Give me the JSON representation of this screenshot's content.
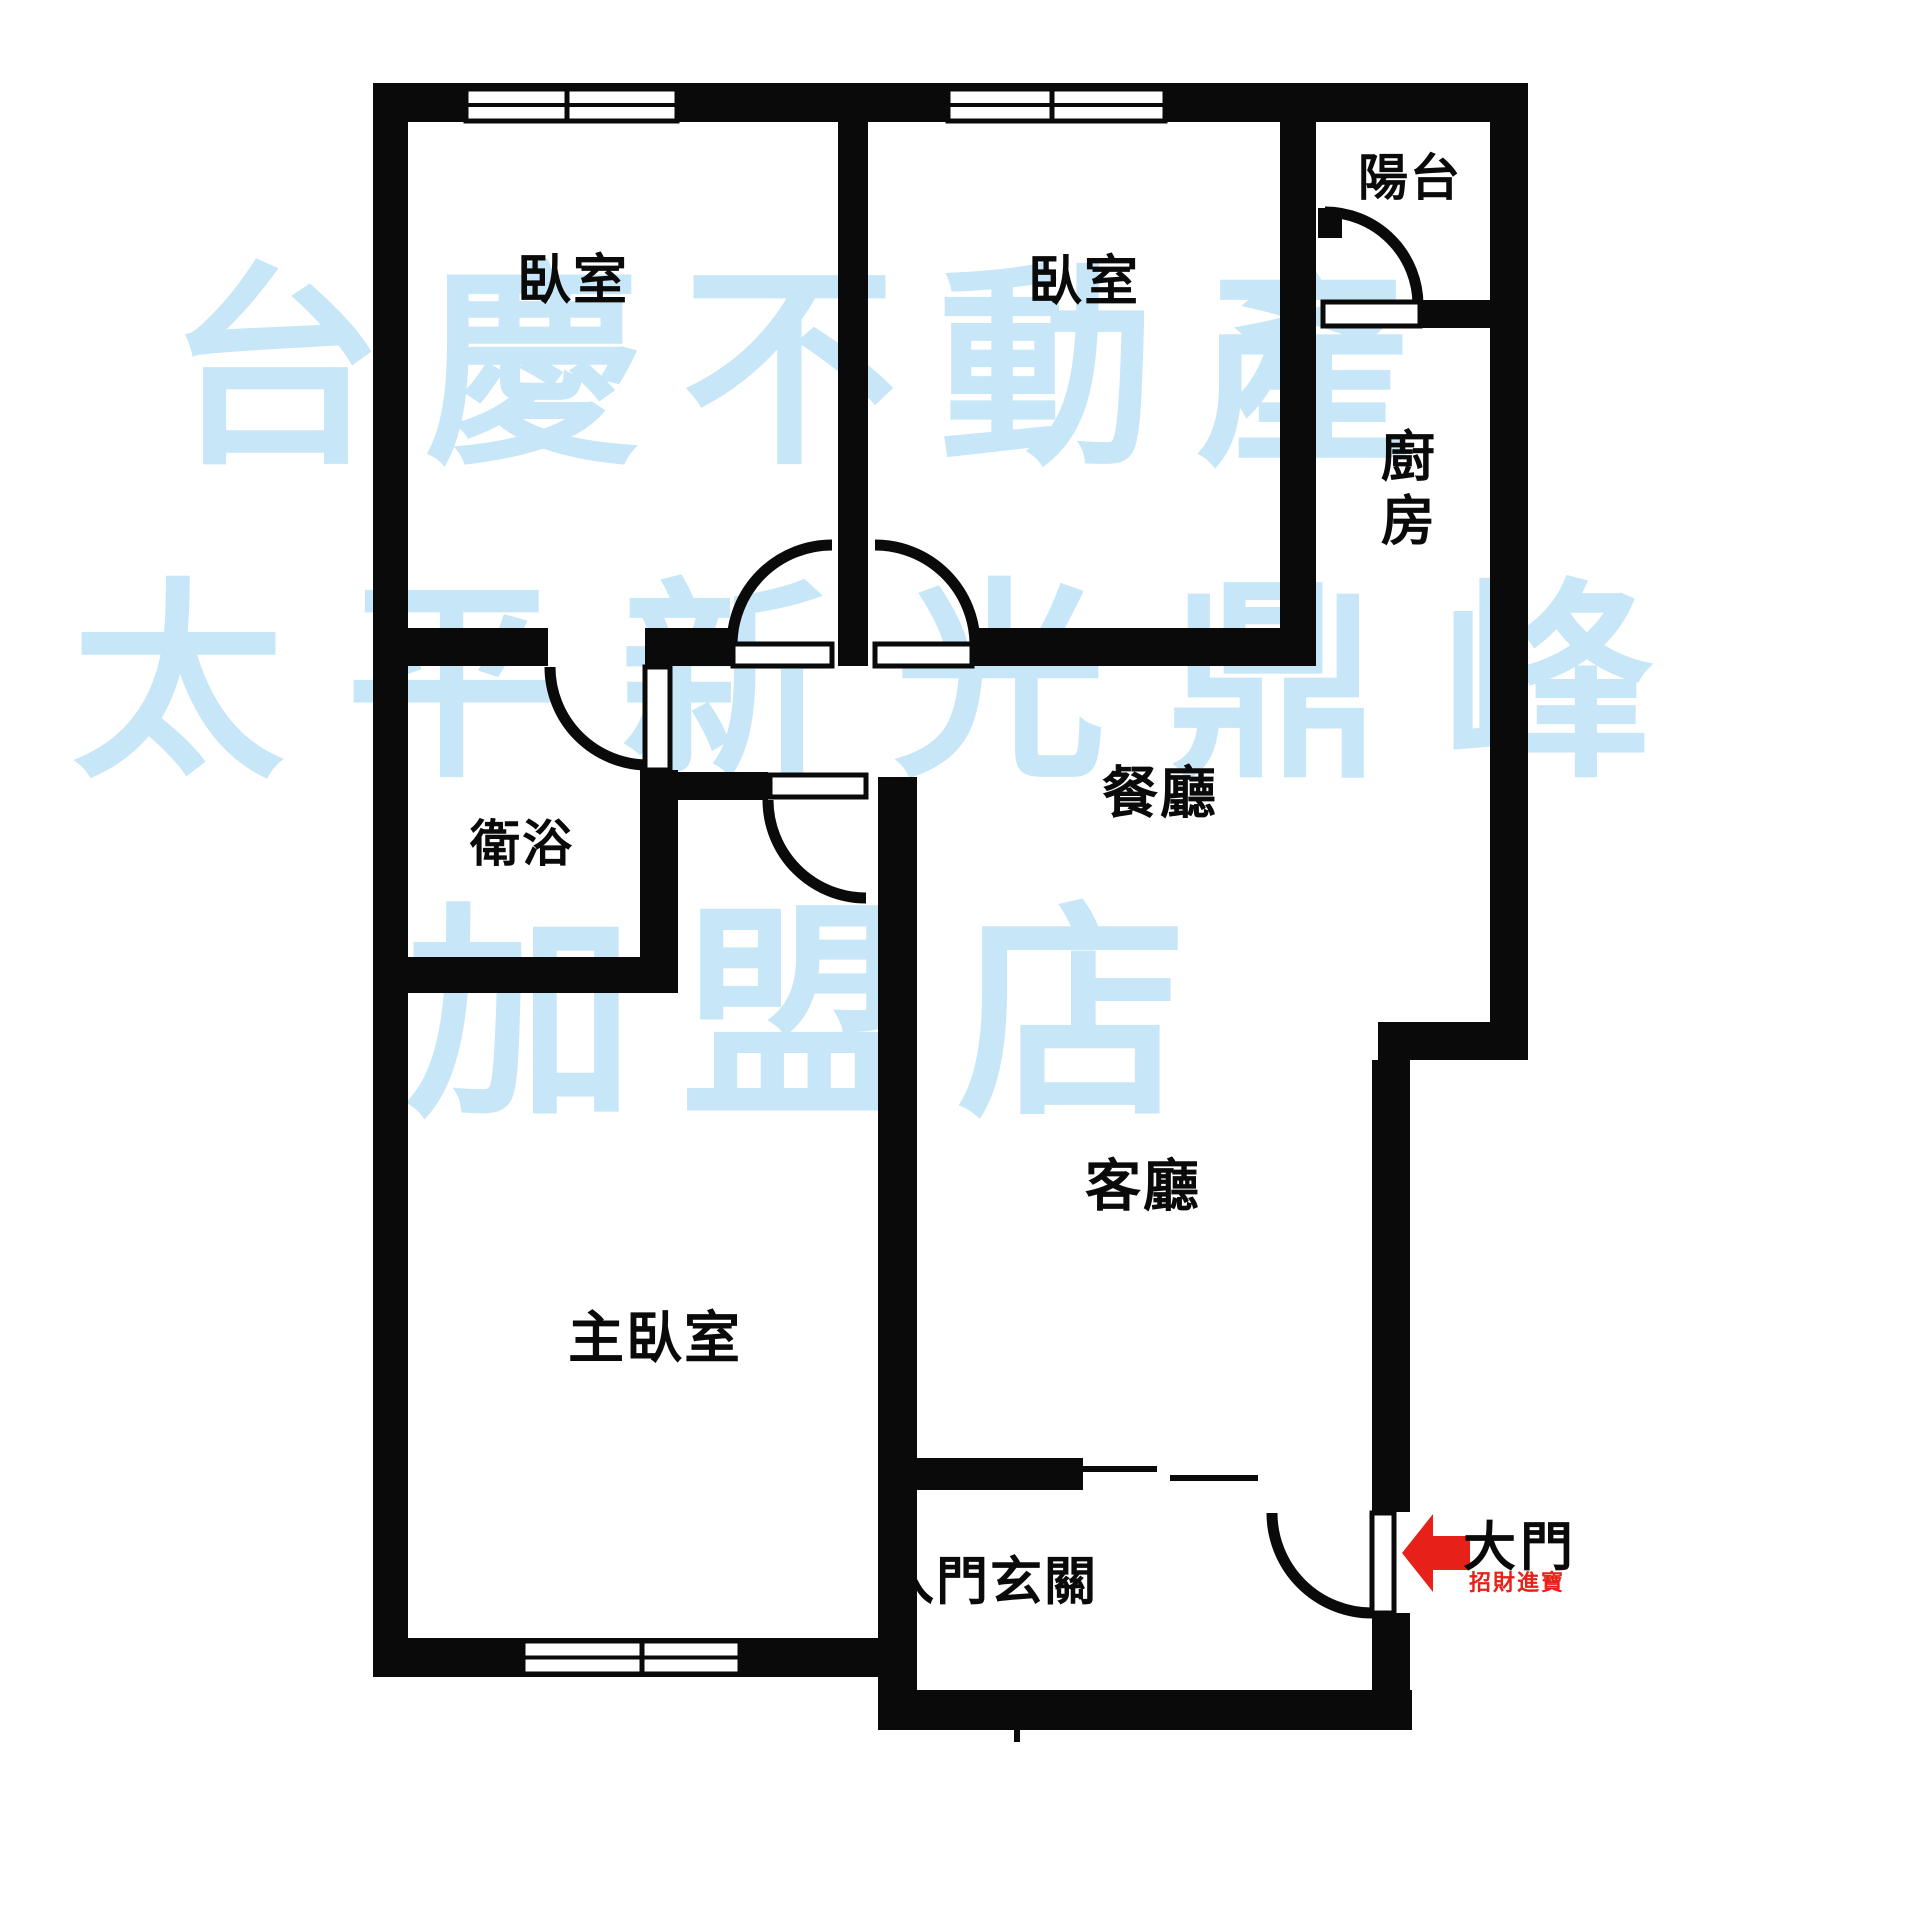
{
  "page": {
    "background": "#ffffff",
    "wall_color": "#0a0a0a",
    "label_color": "#0a0a0a",
    "accent_red": "#e7211a",
    "watermark_color": "#c7e6f7"
  },
  "watermark": {
    "rows": [
      {
        "text": "台慶不動產",
        "left": 168,
        "top": 262,
        "font_size": 215,
        "letter_spacing": 42
      },
      {
        "text": "太平新光鼎峰",
        "left": 72,
        "top": 578,
        "font_size": 212,
        "letter_spacing": 62
      },
      {
        "text": "加盟店",
        "left": 405,
        "top": 902,
        "font_size": 230,
        "letter_spacing": 46
      }
    ]
  },
  "rooms": [
    {
      "id": "bedroom-1",
      "label": "臥室",
      "cx": 573,
      "cy": 281,
      "font_size": 54
    },
    {
      "id": "bedroom-2",
      "label": "臥室",
      "cx": 1084,
      "cy": 282,
      "font_size": 54
    },
    {
      "id": "balcony",
      "label": "陽台",
      "cx": 1410,
      "cy": 178,
      "font_size": 50
    },
    {
      "id": "kitchen",
      "label": "廚房",
      "cx": 1402,
      "cy": 492,
      "font_size": 54,
      "vertical": true
    },
    {
      "id": "bathroom",
      "label": "衛浴",
      "cx": 522,
      "cy": 844,
      "font_size": 50
    },
    {
      "id": "dining-room",
      "label": "餐廳",
      "cx": 1160,
      "cy": 795,
      "font_size": 56
    },
    {
      "id": "living-room",
      "label": "客廳",
      "cx": 1143,
      "cy": 1188,
      "font_size": 56
    },
    {
      "id": "master-bedroom",
      "label": "主臥室",
      "cx": 655,
      "cy": 1340,
      "font_size": 56
    },
    {
      "id": "foyer",
      "label": "入門玄關",
      "cx": 990,
      "cy": 1583,
      "font_size": 52
    }
  ],
  "entrance": {
    "label": "大門",
    "label_cx": 1520,
    "label_cy": 1543,
    "label_font_size": 53,
    "blessing": "招財進寶",
    "blessing_cx": 1517,
    "blessing_cy": 1581,
    "blessing_font_size": 22,
    "arrow_points": "1402,1553 1433,1514 1433,1536 1470,1536 1470,1570 1433,1570 1433,1592"
  },
  "plan": {
    "canvas": {
      "width": 1920,
      "height": 1920
    },
    "walls": [
      {
        "name": "outer-top",
        "x": 373,
        "y": 83,
        "w": 1155,
        "h": 39
      },
      {
        "name": "outer-left",
        "x": 373,
        "y": 83,
        "w": 35,
        "h": 1594
      },
      {
        "name": "master-bottom",
        "x": 373,
        "y": 1638,
        "w": 544,
        "h": 39
      },
      {
        "name": "outer-right-upper",
        "x": 1490,
        "y": 83,
        "w": 38,
        "h": 977
      },
      {
        "name": "living-step",
        "x": 1378,
        "y": 1022,
        "w": 150,
        "h": 38
      },
      {
        "name": "entry-right-upper",
        "x": 1372,
        "y": 1060,
        "w": 38,
        "h": 452
      },
      {
        "name": "entry-right-lower",
        "x": 1372,
        "y": 1613,
        "w": 38,
        "h": 117
      },
      {
        "name": "foyer-bottom",
        "x": 878,
        "y": 1690,
        "w": 534,
        "h": 40
      },
      {
        "name": "hall-band-left",
        "x": 408,
        "y": 628,
        "w": 140,
        "h": 38
      },
      {
        "name": "hall-band-mid",
        "x": 645,
        "y": 628,
        "w": 88,
        "h": 38
      },
      {
        "name": "bedroom-divider",
        "x": 838,
        "y": 122,
        "w": 30,
        "h": 544
      },
      {
        "name": "hall-band-right",
        "x": 972,
        "y": 628,
        "w": 344,
        "h": 38
      },
      {
        "name": "kitchen-left",
        "x": 1280,
        "y": 122,
        "w": 36,
        "h": 544
      },
      {
        "name": "balcony-bottom",
        "x": 1420,
        "y": 300,
        "w": 70,
        "h": 28
      },
      {
        "name": "balcony-door-post",
        "x": 1318,
        "y": 208,
        "w": 24,
        "h": 30
      },
      {
        "name": "bathroom-right",
        "x": 640,
        "y": 770,
        "w": 38,
        "h": 223
      },
      {
        "name": "bathroom-bottom",
        "x": 408,
        "y": 957,
        "w": 270,
        "h": 36
      },
      {
        "name": "master-door-wall",
        "x": 640,
        "y": 772,
        "w": 128,
        "h": 28
      },
      {
        "name": "main-vertical",
        "x": 878,
        "y": 777,
        "w": 39,
        "h": 953
      },
      {
        "name": "foyer-top",
        "x": 917,
        "y": 1458,
        "w": 166,
        "h": 32
      }
    ],
    "thin_lines": [
      {
        "name": "foyer-slide-line-1",
        "x": 1083,
        "y": 1466,
        "w": 74,
        "h": 6
      },
      {
        "name": "foyer-slide-line-2",
        "x": 1170,
        "y": 1475,
        "w": 88,
        "h": 6
      },
      {
        "name": "foyer-bottom-tick",
        "x": 1014,
        "y": 1728,
        "w": 6,
        "h": 14
      }
    ],
    "windows": [
      {
        "name": "bedroom-1-window",
        "x": 466,
        "y": 89,
        "w": 211,
        "h": 32,
        "divider_x": 567
      },
      {
        "name": "bedroom-2-window",
        "x": 948,
        "y": 89,
        "w": 217,
        "h": 32,
        "divider_x": 1052
      },
      {
        "name": "master-bedroom-window",
        "x": 523,
        "y": 1641,
        "w": 217,
        "h": 33,
        "divider_x": 642
      }
    ],
    "doors": [
      {
        "name": "bedroom-1-door",
        "arc": "M 732 645 A 100 100 0 0 1 832 545",
        "leaf": {
          "x": 733,
          "y": 644,
          "w": 99,
          "h": 22
        }
      },
      {
        "name": "bedroom-2-door",
        "arc": "M 875 545 A 100 100 0 0 1 975 645",
        "leaf": {
          "x": 875,
          "y": 644,
          "w": 97,
          "h": 22
        }
      },
      {
        "name": "bathroom-door",
        "arc": "M 550 667 A 98 98 0 0 0 648 765",
        "leaf": {
          "x": 645,
          "y": 667,
          "w": 25,
          "h": 103
        }
      },
      {
        "name": "master-bedroom-door",
        "arc": "M 768 800 A 98 98 0 0 0 866 898",
        "leaf": {
          "x": 770,
          "y": 775,
          "w": 96,
          "h": 22
        }
      },
      {
        "name": "balcony-door",
        "arc": "M 1325 212 A 93 93 0 0 1 1418 305",
        "leaf": {
          "x": 1323,
          "y": 302,
          "w": 97,
          "h": 24
        }
      },
      {
        "name": "entrance-door",
        "arc": "M 1272 1513 A 100 100 0 0 0 1372 1613",
        "leaf": {
          "x": 1372,
          "y": 1513,
          "w": 22,
          "h": 100
        }
      }
    ]
  }
}
